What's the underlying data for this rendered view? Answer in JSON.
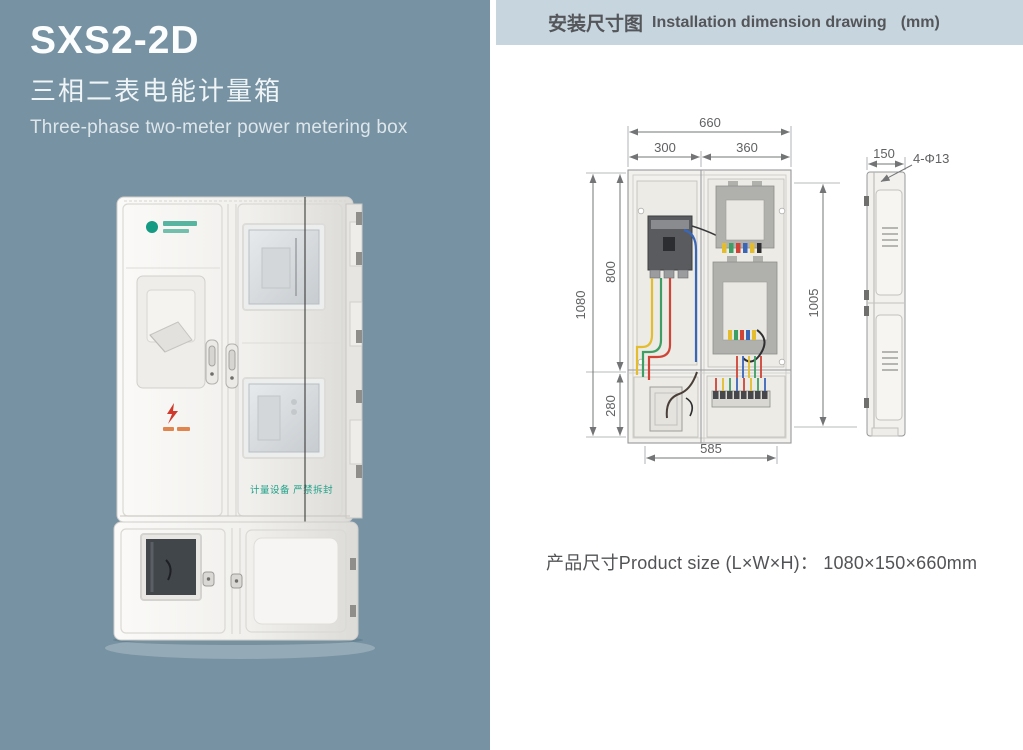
{
  "colors": {
    "panel-bg": "#7792a2",
    "header-bg": "#c6d5de",
    "header-text": "#55565a",
    "text-dark": "#525356",
    "dim-line": "#737476",
    "badge-green": "#1fa188",
    "warning-red": "#cf3a2c"
  },
  "left_panel": {
    "model": "SXS2-2D",
    "subtitle_cn": "三相二表电能计量箱",
    "subtitle_en": "Three-phase two-meter power metering box",
    "photo": {
      "badge_text": "计量设备 严禁拆封"
    }
  },
  "right_panel": {
    "header": {
      "title_cn": "安装尺寸图",
      "title_en": "Installation dimension drawing",
      "unit": "(mm)"
    },
    "drawing": {
      "dims": {
        "total_width": "660",
        "left_width": "300",
        "right_width": "360",
        "total_height": "1080",
        "upper_height": "800",
        "lower_height": "280",
        "bottom_width": "585",
        "right_height": "1005",
        "depth": "150",
        "mount_holes": "4-Φ13"
      }
    },
    "product_size": {
      "label": "产品尺寸Product size (L×W×H)：",
      "value": "1080×150×660mm"
    }
  }
}
